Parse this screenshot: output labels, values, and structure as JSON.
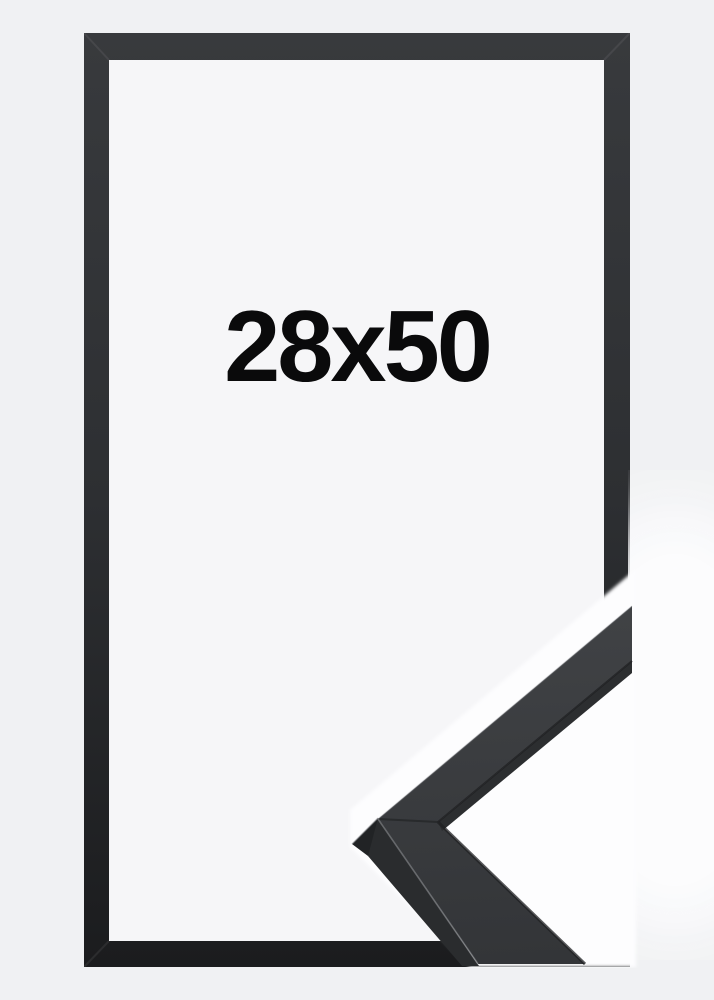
{
  "product": {
    "size_label": "28x50",
    "kind": "picture-frame-product-image",
    "frame_style": "thin matte black wood frame",
    "view": "front outline with enlarged mitred corner detail at bottom right"
  },
  "colors": {
    "bg_outer": "#f0f1f3",
    "bg_inner": "#f6f6f8",
    "frame_top": "#383a3d",
    "frame_mid": "#2d2f32",
    "frame_bottom": "#1b1c1e",
    "photo_white": "#fdfdfe",
    "moulding_light": "#404245",
    "moulding_dark": "#333538",
    "moulding_side": "#2a2c2e",
    "moulding_bevel": "#212325",
    "moulding_inner_band": "#2c2e30",
    "edge_highlight": "#97999d",
    "text_color": "#0a0a0b"
  }
}
